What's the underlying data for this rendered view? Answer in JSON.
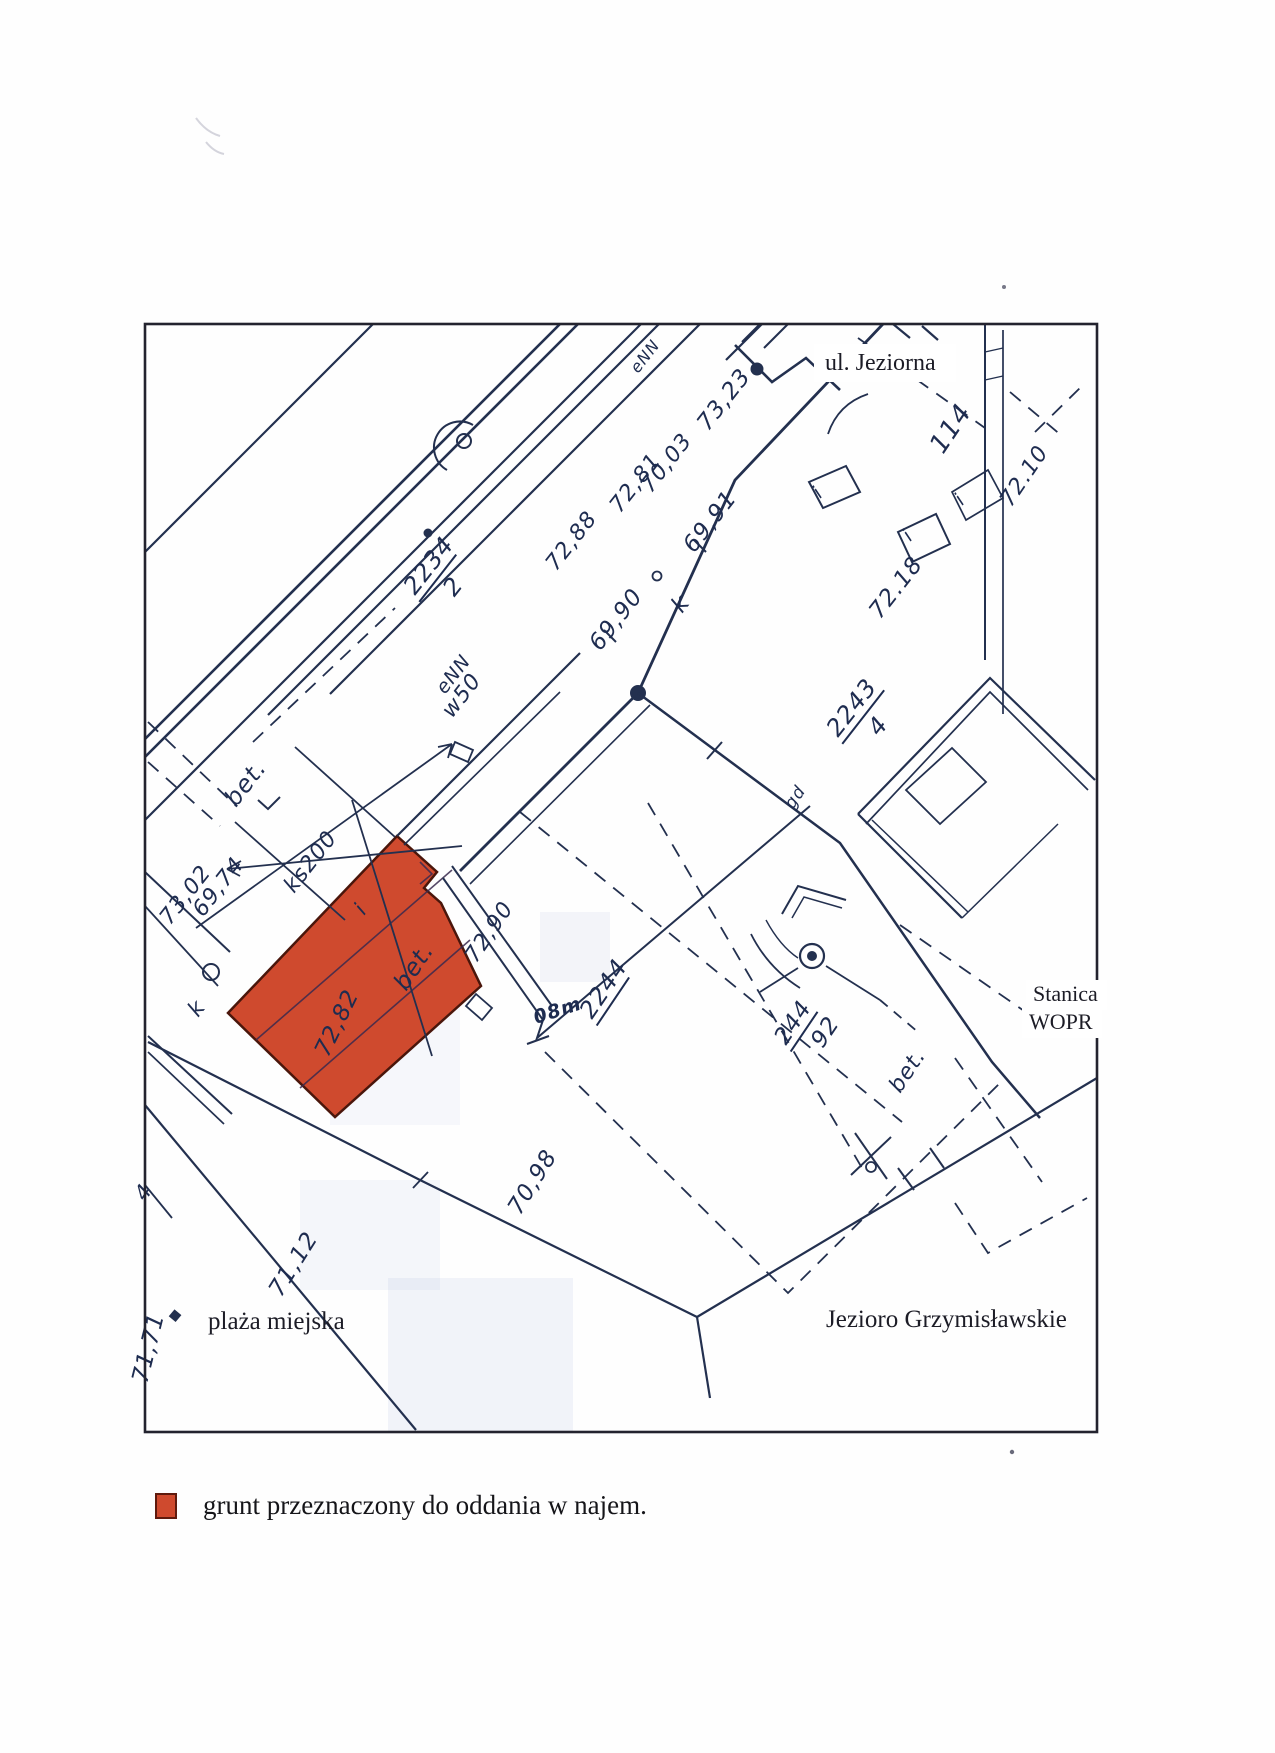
{
  "document": {
    "type": "scanned cadastral map excerpt",
    "ink_color": "#23304f",
    "highlight_color": "#cf4a2e"
  },
  "map": {
    "place_labels": [
      {
        "text": "ul. Jeziorna"
      },
      {
        "text": "Stanica"
      },
      {
        "text": "WOPR"
      },
      {
        "text": "plaża miejska"
      },
      {
        "text": "Jezioro Grzymisławskie"
      }
    ],
    "hand_labels": [
      {
        "text": "2234",
        "x": 415,
        "y": 596,
        "rot": -52,
        "size": 24,
        "bar": 58,
        "den": "2"
      },
      {
        "text": "2243",
        "x": 838,
        "y": 738,
        "rot": -52,
        "size": 24,
        "bar": 66,
        "den": "4"
      },
      {
        "text": "2244",
        "x": 592,
        "y": 1020,
        "rot": -56,
        "size": 24,
        "bar": 56
      },
      {
        "text": "244",
        "x": 786,
        "y": 1046,
        "rot": -56,
        "size": 23,
        "bar": 46,
        "den": "92"
      },
      {
        "text": "72,88",
        "x": 556,
        "y": 572,
        "rot": -52,
        "size": 22
      },
      {
        "text": "72,81",
        "x": 620,
        "y": 514,
        "rot": -52,
        "size": 22
      },
      {
        "text": "70,03",
        "x": 651,
        "y": 494,
        "rot": -52,
        "size": 22
      },
      {
        "text": "73,23",
        "x": 708,
        "y": 432,
        "rot": -52,
        "size": 23
      },
      {
        "text": "69,90",
        "x": 600,
        "y": 652,
        "rot": -52,
        "size": 23
      },
      {
        "text": "k",
        "x": 682,
        "y": 614,
        "rot": -52,
        "size": 23
      },
      {
        "text": "69,91",
        "x": 694,
        "y": 554,
        "rot": -52,
        "size": 23
      },
      {
        "text": "eNN",
        "x": 638,
        "y": 374,
        "rot": -52,
        "size": 16
      },
      {
        "text": "eNN",
        "x": 445,
        "y": 695,
        "rot": -52,
        "size": 19
      },
      {
        "text": "w50",
        "x": 452,
        "y": 719,
        "rot": -52,
        "size": 22
      },
      {
        "text": "72.18",
        "x": 880,
        "y": 620,
        "rot": -52,
        "size": 23
      },
      {
        "text": "114",
        "x": 943,
        "y": 455,
        "rot": -56,
        "size": 26
      },
      {
        "text": "72.10",
        "x": 1011,
        "y": 508,
        "rot": -56,
        "size": 22
      },
      {
        "text": "bet.",
        "x": 236,
        "y": 808,
        "rot": -52,
        "size": 24,
        "italic": true
      },
      {
        "text": "73,02",
        "x": 170,
        "y": 926,
        "rot": -52,
        "size": 22
      },
      {
        "text": "69,74",
        "x": 203,
        "y": 918,
        "rot": -52,
        "size": 22
      },
      {
        "text": "ks200",
        "x": 294,
        "y": 894,
        "rot": -52,
        "size": 22
      },
      {
        "text": "k",
        "x": 198,
        "y": 1018,
        "rot": -52,
        "size": 22
      },
      {
        "text": "72,82",
        "x": 328,
        "y": 1058,
        "rot": -64,
        "size": 23
      },
      {
        "text": "bet.",
        "x": 406,
        "y": 992,
        "rot": -56,
        "size": 24,
        "italic": true
      },
      {
        "text": "i",
        "x": 364,
        "y": 916,
        "rot": -52,
        "size": 21
      },
      {
        "text": "72,90",
        "x": 476,
        "y": 964,
        "rot": -56,
        "size": 22
      },
      {
        "text": "08m",
        "x": 536,
        "y": 1024,
        "rot": -18,
        "size": 19,
        "bold": true
      },
      {
        "text": "bet.",
        "x": 900,
        "y": 1094,
        "rot": -56,
        "size": 22,
        "italic": true
      },
      {
        "text": "gd",
        "x": 793,
        "y": 810,
        "rot": -56,
        "size": 17
      },
      {
        "text": "70,98",
        "x": 520,
        "y": 1216,
        "rot": -58,
        "size": 23
      },
      {
        "text": "71,12",
        "x": 281,
        "y": 1298,
        "rot": -58,
        "size": 23
      },
      {
        "text": "71,71",
        "x": 147,
        "y": 1384,
        "rot": -76,
        "size": 23
      },
      {
        "text": "4",
        "x": 145,
        "y": 1202,
        "rot": -55,
        "size": 21
      },
      {
        "text": "i",
        "x": 820,
        "y": 499,
        "rot": -45,
        "size": 19
      },
      {
        "text": "i",
        "x": 910,
        "y": 542,
        "rot": -45,
        "size": 19
      },
      {
        "text": "i",
        "x": 962,
        "y": 506,
        "rot": -45,
        "size": 19
      }
    ]
  },
  "legend": {
    "swatch_color": "#cf4a2e",
    "text": "grunt przeznaczony do oddania w najem."
  }
}
